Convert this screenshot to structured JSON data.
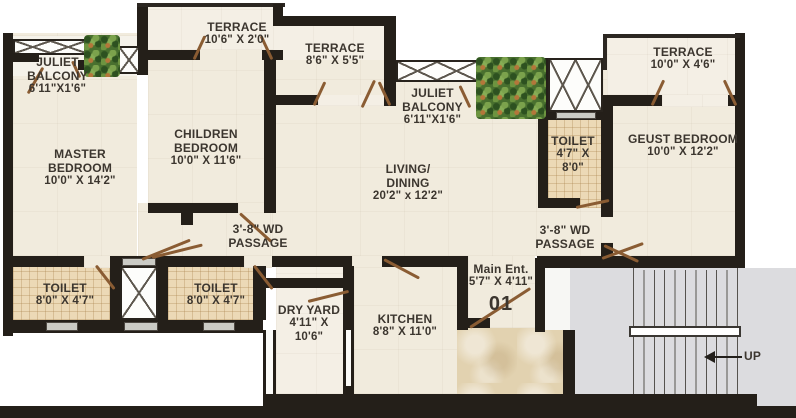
{
  "plan_title": "apartment-floor-plan",
  "colors": {
    "wall": "#241f19",
    "floor_beige": "#f1ebdd",
    "toilet_tile": "#ecd9b6",
    "stairs_gray": "#dcdcdf",
    "plant_green": "#49702f",
    "door_swing_brown": "#8a5c33",
    "foyer_tan": "#e2d2b0"
  },
  "rooms": {
    "juliet_balcony_left": {
      "name": "JULIET BALCONY",
      "dims": "6'11\"X1'6\""
    },
    "terrace_top_left": {
      "name": "TERRACE",
      "dims": "10'6\" X 2'0\""
    },
    "terrace_mid": {
      "name": "TERRACE",
      "dims": "8'6\" X 5'5\""
    },
    "juliet_balcony_mid": {
      "name": "JULIET BALCONY",
      "dims": "6'11\"X1'6\""
    },
    "terrace_right": {
      "name": "TERRACE",
      "dims": "10'0\" X 4'6\""
    },
    "master_bedroom": {
      "name": "MASTER BEDROOM",
      "dims": "10'0\" X 14'2\""
    },
    "children_bedroom": {
      "name": "CHILDREN BEDROOM",
      "dims": "10'0\" X 11'6\""
    },
    "living_dining": {
      "name": "LIVING/ DINING",
      "dims": "20'2\" x 12'2\""
    },
    "toilet_mid": {
      "name": "TOILET",
      "dims": "4'7\" X 8'0\""
    },
    "guest_bedroom": {
      "name": "GEUST BEDROOM",
      "dims": "10'0\" X 12'2\""
    },
    "passage_left": {
      "name": "3'-8\" WD PASSAGE"
    },
    "passage_right": {
      "name": "3'-8\" WD PASSAGE"
    },
    "toilet_left": {
      "name": "TOILET",
      "dims": "8'0\" X 4'7\""
    },
    "toilet_right": {
      "name": "TOILET",
      "dims": "8'0\" X 4'7\""
    },
    "dry_yard": {
      "name": "DRY YARD",
      "dims": "4'11\" X 10'6\""
    },
    "kitchen": {
      "name": "KITCHEN",
      "dims": "8'8\" X 11'0\""
    },
    "main_entrance": {
      "name": "Main Ent.",
      "dims": "5'7\" X 4'11\"",
      "unit_number": "01"
    },
    "staircase": {
      "direction_label": "UP"
    }
  }
}
